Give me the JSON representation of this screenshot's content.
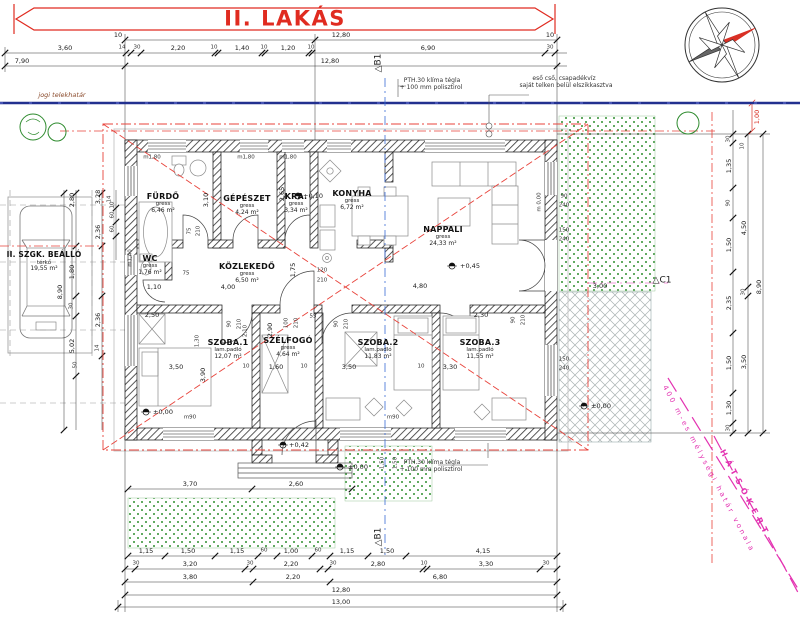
{
  "title": "II. LAKÁS",
  "site": {
    "boundary": "jogi telekhatár",
    "hatsokert": "HÁTSÓKERT",
    "depth_line": "400 m-es mélységi határ vonala",
    "note_pth_1": "PTH.30 klíma tégla",
    "note_pth_2": "+ 100 mm polisztirol",
    "note_rain_1": "eső cső, csapadékvíz",
    "note_rain_2": "saját telken belül elszikkasztva"
  },
  "sections": {
    "b1": "△B1",
    "c1": "△C1"
  },
  "parking": {
    "name": "II. SZGK. BEÁLLÓ",
    "finish": "térkő",
    "area": "19,55 m²"
  },
  "rooms": [
    {
      "name": "FÜRDŐ",
      "finish": "gress",
      "area": "6,46 m²"
    },
    {
      "name": "GÉPÉSZET",
      "finish": "gress",
      "area": "4,24 m²"
    },
    {
      "name": "KRA.",
      "finish": "gress",
      "area": "3,34 m²"
    },
    {
      "name": "KONYHA",
      "finish": "gress",
      "area": "6,72 m²"
    },
    {
      "name": "NAPPALI",
      "finish": "gress",
      "area": "24,33 m²"
    },
    {
      "name": "WC",
      "finish": "gress",
      "area": "1,76 m²"
    },
    {
      "name": "KÖZLEKEDŐ",
      "finish": "gress",
      "area": "6,50 m²"
    },
    {
      "name": "SZOBA.1",
      "finish": "lam.padló",
      "area": "12,07 m²"
    },
    {
      "name": "SZÉLFOGÓ",
      "finish": "gress",
      "area": "4,64 m²"
    },
    {
      "name": "SZOBA.2",
      "finish": "lam.padló",
      "area": "11,83 m²"
    },
    {
      "name": "SZOBA.3",
      "finish": "lam.padló",
      "area": "11,55 m²"
    }
  ],
  "levels": {
    "p045": "+0,45",
    "z000": "±0,00",
    "p042": "+0,42",
    "p010": "+0,10"
  },
  "ol": {
    "m180": "m1,80",
    "n90": "90",
    "n240": "240",
    "n150": "150",
    "n210": "210",
    "n75": "75",
    "n100": "100",
    "n120": "120",
    "n55": "55",
    "m90": "m90",
    "m140": "m1,40",
    "m000": "m 0,00"
  },
  "dims": {
    "top1": [
      "10",
      "12,80",
      "10"
    ],
    "top2": [
      "3,60",
      "14",
      "30",
      "2,20",
      "10",
      "1,40",
      "10",
      "1,20",
      "10",
      "6,90",
      "30"
    ],
    "top3": [
      "7,90",
      "12,80"
    ],
    "bot1": [
      "1,15",
      "1,50",
      "1,15",
      "60",
      "1,00",
      "60",
      "1,15",
      "1,50",
      "4,15"
    ],
    "bot2": [
      "30",
      "3,20",
      "30",
      "2,20",
      "30",
      "2,80",
      "10",
      "3,30",
      "30"
    ],
    "bot3": [
      "3,80",
      "2,20",
      "6,80"
    ],
    "bot4": [
      "12,80"
    ],
    "bot5": [
      "13,00"
    ],
    "right": [
      "30",
      "10",
      "1,35",
      "90",
      "1,50",
      "2,35",
      "1,50",
      "1,30",
      "30",
      "4,50",
      "30",
      "3,50",
      "8,90"
    ],
    "r100": "1,00",
    "left": [
      "2,80",
      "3,28",
      "14",
      "60",
      "60",
      "10",
      "1,80",
      "2,36",
      "8,90",
      "30",
      "2,36",
      "5,02",
      "14",
      "50"
    ],
    "inner": [
      "3,10",
      "2,65",
      "2,50",
      "3,50",
      "3,90",
      "10",
      "1,60",
      "10",
      "3,50",
      "2,30",
      "10",
      "3,30",
      "2,90",
      "1,75",
      "4,80",
      "3,00",
      "1,10",
      "4,00",
      "75",
      "1,30",
      "3,70",
      "2,60",
      "1,50",
      "1,50",
      "2,10"
    ]
  }
}
